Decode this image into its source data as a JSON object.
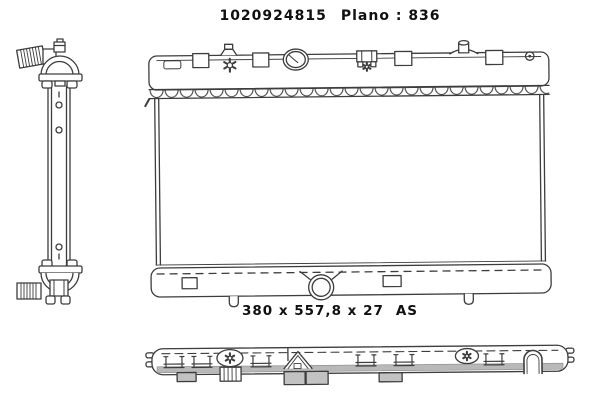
{
  "page": {
    "background_color": "#ffffff",
    "line_color": "#3d3d3d",
    "shading_color": "#c2c2c2"
  },
  "header": {
    "part_number": "1020924815",
    "plan_label": "Plano : 836"
  },
  "dimensions_label": {
    "size": "380 x 557,8 x 27",
    "suffix": "AS"
  }
}
